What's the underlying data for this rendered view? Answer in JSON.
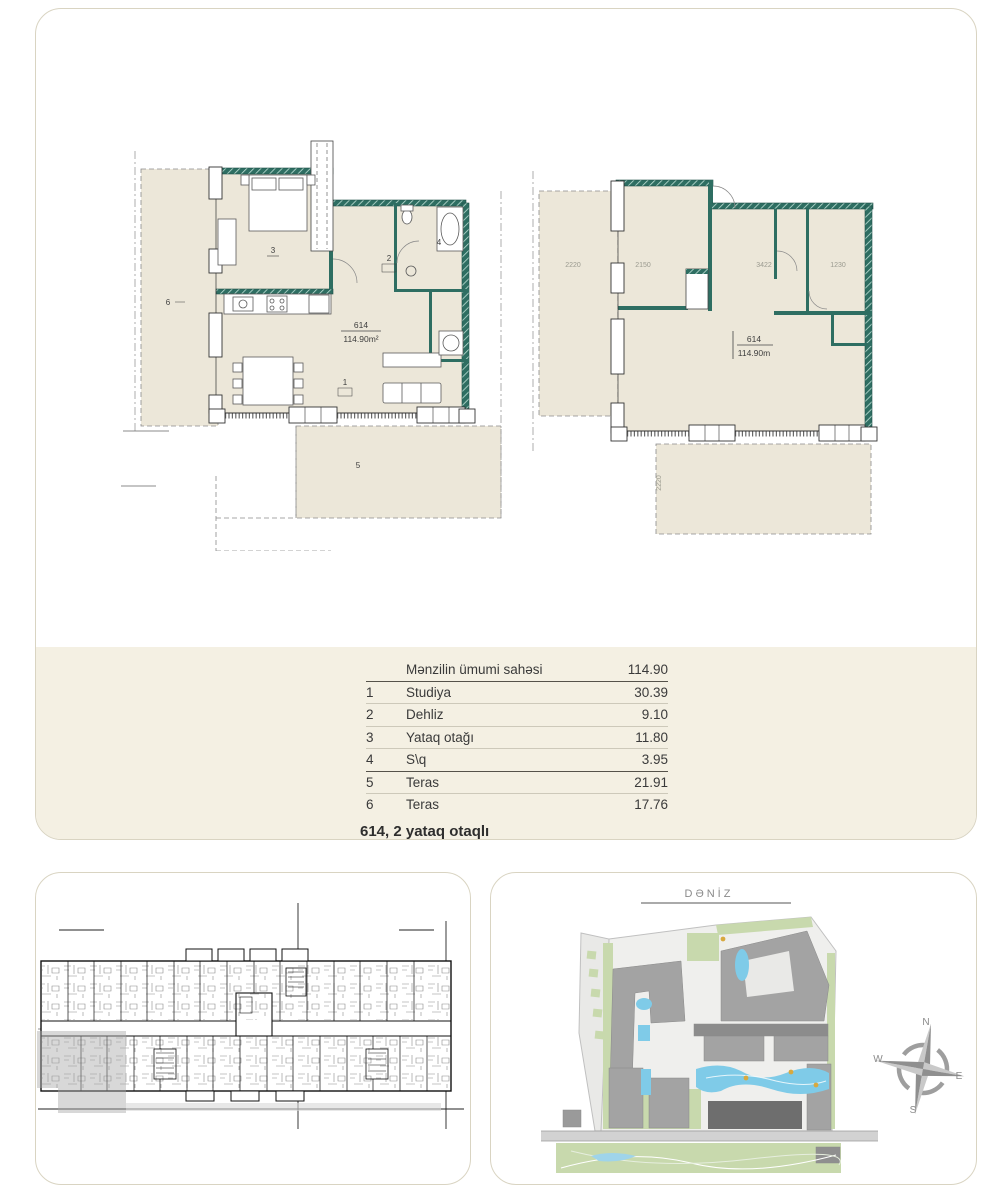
{
  "page": {
    "title": "614, 2 yataq otaqlı"
  },
  "area_table": {
    "header": {
      "label": "Mənzilin ümumi sahəsi",
      "value": "114.90"
    },
    "rows": [
      {
        "num": "1",
        "name": "Studiya",
        "value": "30.39"
      },
      {
        "num": "2",
        "name": "Dehliz",
        "value": "9.10"
      },
      {
        "num": "3",
        "name": "Yataq otağı",
        "value": "11.80"
      },
      {
        "num": "4",
        "name": "S\\q",
        "value": "3.95"
      },
      {
        "num": "5",
        "name": "Teras",
        "value": "21.91"
      },
      {
        "num": "6",
        "name": "Teras",
        "value": "17.76"
      }
    ],
    "footer_title": "614, 2 yataq otaqlı"
  },
  "plans": {
    "left": {
      "unit_number": "614",
      "area_label": "114.90m²",
      "rooms": {
        "r1": "1",
        "r2": "2",
        "r3": "3",
        "r4": "4",
        "r5": "5",
        "r6": "6"
      }
    },
    "right": {
      "unit_number": "614",
      "area_label": "114.90m",
      "dims": [
        "2220",
        "2150",
        "3422",
        "1230"
      ],
      "vertical_dim": "2220"
    }
  },
  "site_plan": {
    "sea_label": "DƏNİZ",
    "compass": {
      "n": "N",
      "e": "E",
      "s": "S",
      "w": "W"
    }
  },
  "colors": {
    "panel_border": "#d9d4c2",
    "beige_band": "#f4f0e3",
    "floor_fill": "#ece7d9",
    "wall_teal": "#2e6e62",
    "table_text": "#3a3a3a",
    "line_dark": "#55524a",
    "line_light": "#cdc9ba",
    "building_gray": "#a3a3a3",
    "highlight_building": "#6e6e6e",
    "green": "#c8d9ad",
    "water": "#7fcbe8",
    "road": "#d2d2d2",
    "compass_gray": "#8f8f8f"
  }
}
